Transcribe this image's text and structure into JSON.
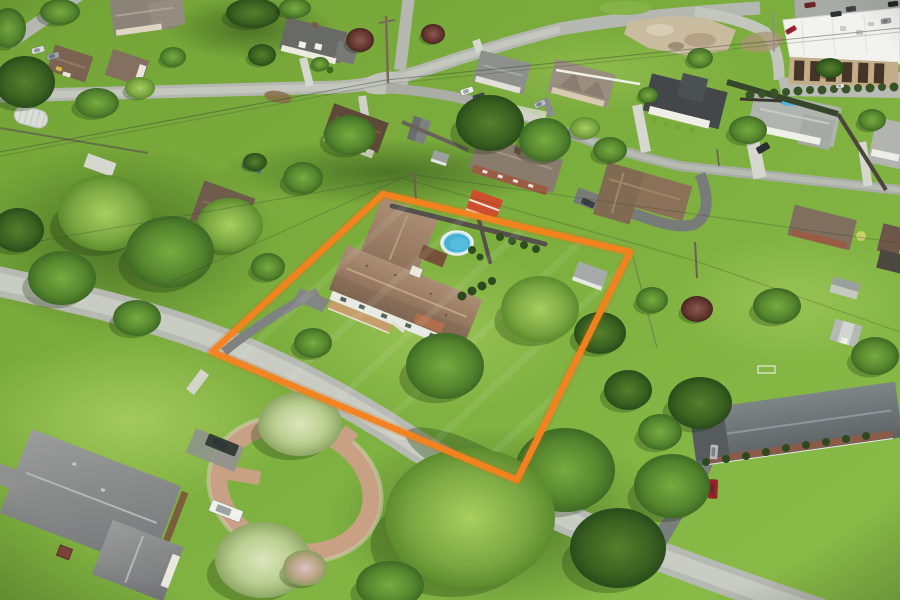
{
  "meta": {
    "type": "aerial-drone-photo",
    "subject": "single-family home on large lawn outlined with orange property boundary",
    "setting": "suburban residential neighborhood, summer, oblique aerial view"
  },
  "annotation": {
    "boundary_color": "#F5821F",
    "boundary_glow": "#C96A10",
    "boundary_points": "212,352 383,194 630,252 517,480",
    "boundary_stroke_px": 6.5
  },
  "palette": {
    "lawn_light": "#8CBF4A",
    "lawn_dark": "#6FA034",
    "road": "#B7BAB2",
    "asphalt": "#7B7F7B",
    "concrete": "#D6D8CF",
    "subject_roof": "#977A61",
    "pool_water": "#44B1D6",
    "flower_tree": "#D4DFAE"
  },
  "subject_property": {
    "features": [
      "brown hip-roof house",
      "front porch",
      "above-ground pool",
      "pool deck",
      "privacy fence",
      "storage shed",
      "red-roof shed",
      "asphalt driveway",
      "large shade trees"
    ]
  },
  "scene_inventory": {
    "houses_visible": 18,
    "sheds_visible": 8,
    "roads": [
      "main street (diagonal, lower left)",
      "top cross street",
      "north spur",
      "right side street",
      "commercial access drive"
    ],
    "commercial_buildings": 1,
    "pools_visible": 2
  },
  "trees": [
    {
      "x": 60,
      "y": 12,
      "rx": 20,
      "ry": 13,
      "t": "mid"
    },
    {
      "x": 253,
      "y": 13,
      "rx": 27,
      "ry": 15,
      "t": "dark"
    },
    {
      "x": 295,
      "y": 8,
      "rx": 16,
      "ry": 10,
      "t": "mid"
    },
    {
      "x": 8,
      "y": 28,
      "rx": 18,
      "ry": 20,
      "t": "mid"
    },
    {
      "x": 360,
      "y": 40,
      "rx": 14,
      "ry": 12,
      "t": "maroon"
    },
    {
      "x": 433,
      "y": 34,
      "rx": 12,
      "ry": 10,
      "t": "maroon"
    },
    {
      "x": 262,
      "y": 55,
      "rx": 14,
      "ry": 11,
      "t": "dark"
    },
    {
      "x": 173,
      "y": 57,
      "rx": 13,
      "ry": 10,
      "t": "mid"
    },
    {
      "x": 700,
      "y": 58,
      "rx": 13,
      "ry": 10,
      "t": "mid"
    },
    {
      "x": 320,
      "y": 64,
      "rx": 9,
      "ry": 7,
      "t": "mid"
    },
    {
      "x": 830,
      "y": 68,
      "rx": 14,
      "ry": 10,
      "t": "dark"
    },
    {
      "x": 25,
      "y": 82,
      "rx": 30,
      "ry": 26,
      "t": "dark"
    },
    {
      "x": 140,
      "y": 88,
      "rx": 15,
      "ry": 11,
      "t": "light"
    },
    {
      "x": 97,
      "y": 103,
      "rx": 22,
      "ry": 15,
      "t": "mid"
    },
    {
      "x": 648,
      "y": 95,
      "rx": 10,
      "ry": 8,
      "t": "mid"
    },
    {
      "x": 872,
      "y": 120,
      "rx": 14,
      "ry": 11,
      "t": "mid"
    },
    {
      "x": 490,
      "y": 123,
      "rx": 34,
      "ry": 28,
      "t": "dark"
    },
    {
      "x": 748,
      "y": 130,
      "rx": 19,
      "ry": 14,
      "t": "mid"
    },
    {
      "x": 350,
      "y": 135,
      "rx": 26,
      "ry": 20,
      "t": "mid"
    },
    {
      "x": 545,
      "y": 140,
      "rx": 26,
      "ry": 22,
      "t": "mid"
    },
    {
      "x": 585,
      "y": 128,
      "rx": 15,
      "ry": 11,
      "t": "light"
    },
    {
      "x": 610,
      "y": 150,
      "rx": 17,
      "ry": 13,
      "t": "mid"
    },
    {
      "x": 255,
      "y": 162,
      "rx": 12,
      "ry": 9,
      "t": "dark"
    },
    {
      "x": 303,
      "y": 178,
      "rx": 20,
      "ry": 16,
      "t": "mid"
    },
    {
      "x": 230,
      "y": 225,
      "rx": 33,
      "ry": 27,
      "t": "light"
    },
    {
      "x": 18,
      "y": 230,
      "rx": 26,
      "ry": 22,
      "t": "dark"
    },
    {
      "x": 105,
      "y": 213,
      "rx": 47,
      "ry": 38,
      "t": "light"
    },
    {
      "x": 170,
      "y": 252,
      "rx": 44,
      "ry": 36,
      "t": "mid"
    },
    {
      "x": 62,
      "y": 278,
      "rx": 34,
      "ry": 27,
      "t": "mid"
    },
    {
      "x": 268,
      "y": 267,
      "rx": 17,
      "ry": 14,
      "t": "mid"
    },
    {
      "x": 652,
      "y": 300,
      "rx": 16,
      "ry": 13,
      "t": "mid"
    },
    {
      "x": 697,
      "y": 309,
      "rx": 16,
      "ry": 13,
      "t": "maroon"
    },
    {
      "x": 777,
      "y": 306,
      "rx": 24,
      "ry": 18,
      "t": "mid"
    },
    {
      "x": 540,
      "y": 309,
      "rx": 39,
      "ry": 33,
      "t": "light"
    },
    {
      "x": 600,
      "y": 333,
      "rx": 26,
      "ry": 21,
      "t": "dark"
    },
    {
      "x": 137,
      "y": 318,
      "rx": 24,
      "ry": 18,
      "t": "mid"
    },
    {
      "x": 313,
      "y": 343,
      "rx": 19,
      "ry": 15,
      "t": "mid"
    },
    {
      "x": 875,
      "y": 356,
      "rx": 24,
      "ry": 19,
      "t": "mid"
    },
    {
      "x": 445,
      "y": 366,
      "rx": 39,
      "ry": 33,
      "t": "mid"
    },
    {
      "x": 628,
      "y": 390,
      "rx": 24,
      "ry": 20,
      "t": "dark"
    },
    {
      "x": 700,
      "y": 403,
      "rx": 32,
      "ry": 26,
      "t": "dark"
    },
    {
      "x": 300,
      "y": 424,
      "rx": 42,
      "ry": 32,
      "t": "flower"
    },
    {
      "x": 660,
      "y": 432,
      "rx": 22,
      "ry": 18,
      "t": "mid"
    },
    {
      "x": 565,
      "y": 470,
      "rx": 50,
      "ry": 42,
      "t": "mid"
    },
    {
      "x": 672,
      "y": 486,
      "rx": 38,
      "ry": 32,
      "t": "mid"
    },
    {
      "x": 470,
      "y": 518,
      "rx": 85,
      "ry": 70,
      "t": "light"
    },
    {
      "x": 618,
      "y": 548,
      "rx": 48,
      "ry": 40,
      "t": "dark"
    },
    {
      "x": 263,
      "y": 560,
      "rx": 48,
      "ry": 38,
      "t": "flower"
    },
    {
      "x": 305,
      "y": 568,
      "rx": 22,
      "ry": 18,
      "t": "pink"
    },
    {
      "x": 390,
      "y": 585,
      "rx": 34,
      "ry": 24,
      "t": "mid"
    }
  ],
  "vehicles": [
    {
      "x": 38,
      "y": 50,
      "w": 13,
      "h": 6,
      "r": -15,
      "c": "#d8dbdc"
    },
    {
      "x": 53,
      "y": 56,
      "w": 13,
      "h": 6,
      "r": -15,
      "c": "#9aa0a4"
    },
    {
      "x": 467,
      "y": 91,
      "w": 13,
      "h": 6,
      "r": -18,
      "c": "#eceeec"
    },
    {
      "x": 479,
      "y": 97,
      "w": 12,
      "h": 6,
      "r": -18,
      "c": "#454a50"
    },
    {
      "x": 540,
      "y": 104,
      "w": 12,
      "h": 6,
      "r": -25,
      "c": "#b9bdc0"
    },
    {
      "x": 501,
      "y": 142,
      "w": 15,
      "h": 7,
      "r": 20,
      "c": "#f0f1ee"
    },
    {
      "x": 763,
      "y": 148,
      "w": 13,
      "h": 7,
      "r": -30,
      "c": "#2a2f33"
    },
    {
      "x": 588,
      "y": 203,
      "w": 13,
      "h": 6,
      "r": 25,
      "c": "#3c4146"
    },
    {
      "x": 791,
      "y": 30,
      "w": 11,
      "h": 5,
      "r": -30,
      "c": "#b3202a"
    },
    {
      "x": 810,
      "y": 5,
      "w": 11,
      "h": 5,
      "r": -8,
      "c": "#7e1f26"
    },
    {
      "x": 836,
      "y": 14,
      "w": 11,
      "h": 5,
      "r": -8,
      "c": "#2e3236"
    },
    {
      "x": 851,
      "y": 9,
      "w": 10,
      "h": 5,
      "r": -8,
      "c": "#44484c"
    },
    {
      "x": 886,
      "y": 21,
      "w": 10,
      "h": 5,
      "r": -8,
      "c": "#9ea2a4"
    },
    {
      "x": 893,
      "y": 4,
      "w": 10,
      "h": 5,
      "r": -8,
      "c": "#222628"
    },
    {
      "x": 840,
      "y": 86,
      "w": 8,
      "h": 4,
      "r": -5,
      "c": "#e8e9e7"
    },
    {
      "x": 714,
      "y": 452,
      "w": 8,
      "h": 15,
      "r": 4,
      "c": "#b5b8ba"
    },
    {
      "x": 713,
      "y": 489,
      "w": 9,
      "h": 19,
      "r": 2,
      "c": "#a02026"
    },
    {
      "x": 226,
      "y": 511,
      "w": 33,
      "h": 12,
      "r": 21,
      "c": "#eff1ec"
    },
    {
      "x": 222,
      "y": 445,
      "w": 32,
      "h": 12,
      "r": 22,
      "c": "#343f37"
    }
  ]
}
